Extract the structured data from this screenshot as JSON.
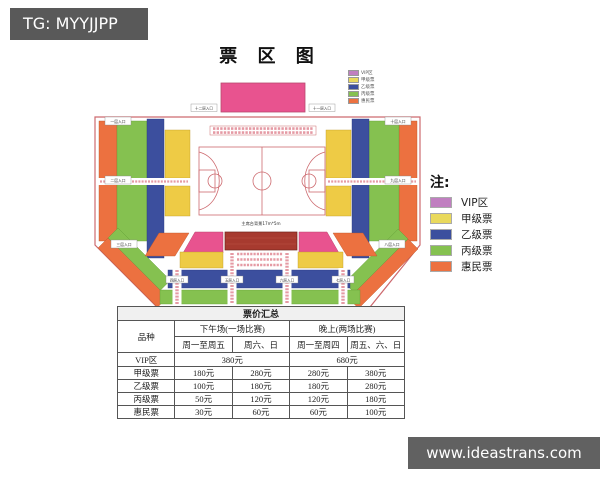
{
  "watermarks": {
    "top_left": "TG: MYYJJPP",
    "bottom_right": "www.ideastrans.com"
  },
  "title": "票 区 图",
  "legend": {
    "title": "注:",
    "items": [
      {
        "label": "VIP区",
        "color": "#c07fc0"
      },
      {
        "label": "甲级票",
        "color": "#e9d95c"
      },
      {
        "label": "乙级票",
        "color": "#3c4f9e"
      },
      {
        "label": "丙级票",
        "color": "#85c150"
      },
      {
        "label": "惠民票",
        "color": "#ec7140"
      }
    ]
  },
  "arena": {
    "stage_label": "舞台台口12m*7m",
    "rostrum_label": "主席台背景17m*5m",
    "entrances": {
      "left_top": "一层入口",
      "left_mid": "二层入口",
      "left_bottom": "三层入口",
      "bottom_1": "四层入口",
      "bottom_2": "五层入口",
      "bottom_3": "六层入口",
      "bottom_4": "七层入口",
      "right_bottom": "八层入口",
      "right_mid": "九层入口",
      "right_top": "十层入口",
      "stage_right": "十一层入口",
      "stage_left": "十二层入口"
    }
  },
  "colors": {
    "stage": "#e8538f",
    "vip_section": "#e8538f",
    "grade_a": "#eecb45",
    "grade_b": "#3c4f9e",
    "grade_c": "#85c150",
    "huimin": "#ec7140",
    "rostrum": "#a73a2f",
    "court_line": "#cd6a6f",
    "border": "#cd6a6f"
  },
  "price_table": {
    "title": "票价汇总",
    "col_category": "品种",
    "group_afternoon": "下午场(一场比赛)",
    "group_evening": "晚上(两场比赛)",
    "sub_headers": [
      "周一至周五",
      "周六、日",
      "周一至周四",
      "周五、六、日"
    ],
    "vip_row": {
      "label": "VIP区",
      "afternoon": "380元",
      "evening": "680元"
    },
    "rows": [
      {
        "label": "甲级票",
        "v": [
          "180元",
          "280元",
          "280元",
          "380元"
        ]
      },
      {
        "label": "乙级票",
        "v": [
          "100元",
          "180元",
          "180元",
          "280元"
        ]
      },
      {
        "label": "丙级票",
        "v": [
          "50元",
          "120元",
          "120元",
          "180元"
        ]
      },
      {
        "label": "惠民票",
        "v": [
          "30元",
          "60元",
          "60元",
          "100元"
        ]
      }
    ]
  }
}
